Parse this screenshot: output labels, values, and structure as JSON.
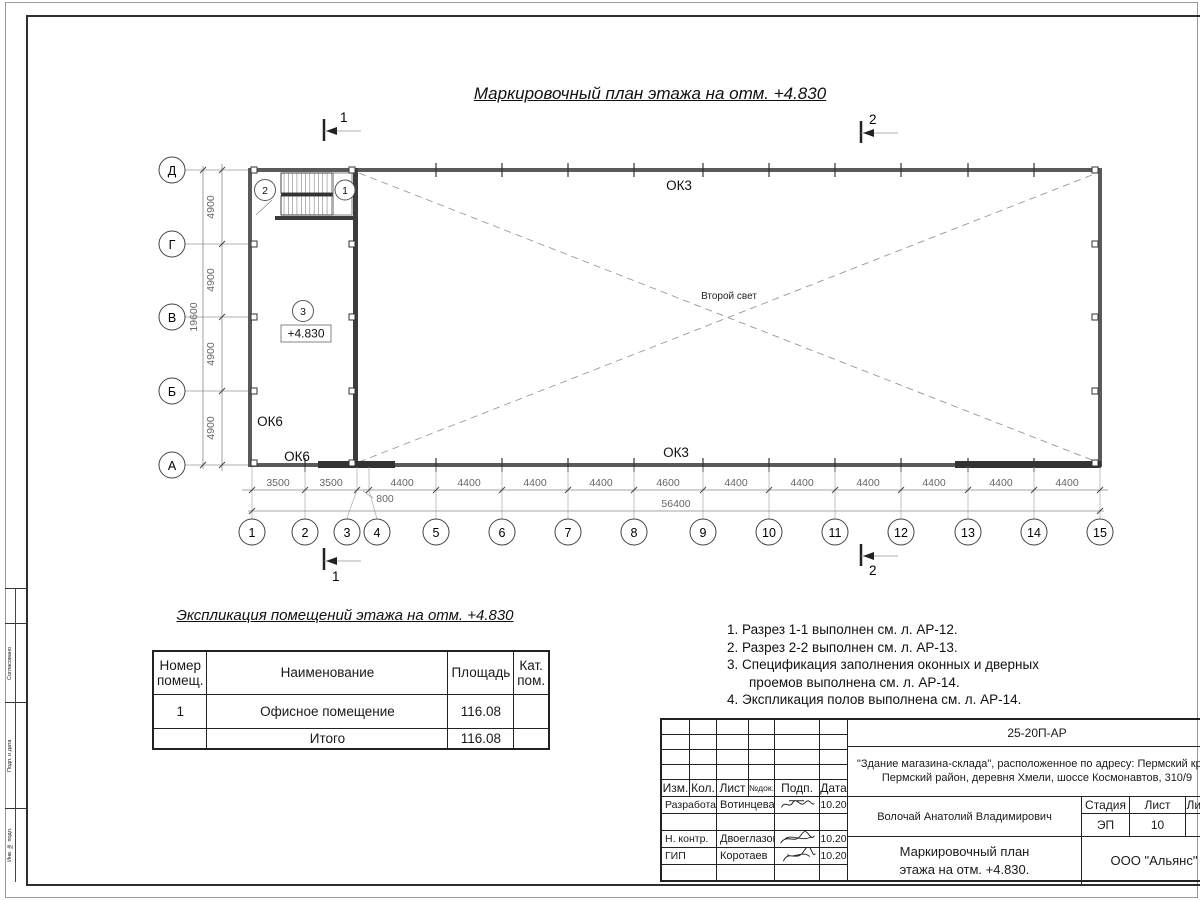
{
  "plan": {
    "title": "Маркировочный план этажа на отм. +4.830",
    "col_axes": [
      "1",
      "2",
      "3",
      "4",
      "5",
      "6",
      "7",
      "8",
      "9",
      "10",
      "11",
      "12",
      "13",
      "14",
      "15"
    ],
    "row_axes": [
      "Д",
      "Г",
      "В",
      "Б",
      "А"
    ],
    "dims_bottom": [
      "3500",
      "3500",
      "4400",
      "4400",
      "4400",
      "4400",
      "4600",
      "4400",
      "4400",
      "4400",
      "4400",
      "4400",
      "4400"
    ],
    "dim_small": "800",
    "dim_total_bottom": "56400",
    "dims_left": [
      "4900",
      "4900",
      "4900",
      "4900"
    ],
    "dim_total_left": "19600",
    "labels": {
      "ok3_top": "ОК3",
      "ok3_bottom": "ОК3",
      "ok6_wall": "ОК6",
      "ok6_bottom": "ОК6",
      "second_light": "Второй свет",
      "level": "+4.830",
      "room": "3",
      "stair_node_left": "2",
      "stair_node_right": "1"
    },
    "sections": {
      "one": "1",
      "two": "2"
    }
  },
  "explication": {
    "title": "Экспликация помещений этажа на отм. +4.830",
    "headers": {
      "number": "Номер помещ.",
      "name": "Наименование",
      "area": "Площадь",
      "cat": "Кат. пом."
    },
    "rows": [
      {
        "number": "1",
        "name": "Офисное помещение",
        "area": "116.08",
        "cat": ""
      }
    ],
    "total_label": "Итого",
    "total_area": "116.08"
  },
  "notes": {
    "line1": "1. Разрез 1-1 выполнен см. л. АР-12.",
    "line2": "2. Разрез 2-2 выполнен см. л. АР-13.",
    "line3": "3. Спецификация заполнения оконных и дверных",
    "line3b": "проемов выполнена см. л. АР-14.",
    "line4": "4. Экспликация полов выполнена см. л. АР-14."
  },
  "stamp": {
    "doc_code": "25-20П-АР",
    "project_line1": "\"Здание магазина-склада\", расположенное по адресу: Пермский край,",
    "project_line2": "Пермский район, деревня Хмели, шоссе Космонавтов, 310/9",
    "header": [
      "Изм.",
      "Кол.",
      "Лист",
      "№док.",
      "Подп.",
      "Дата"
    ],
    "row_developed_label": "Разработал",
    "row_developed_name": "Вотинцева",
    "row_developed_date": "10.20",
    "row_ncontr_label": "Н. контр.",
    "row_ncontr_name": "Двоеглазов",
    "row_ncontr_date": "10.20",
    "row_gip_label": "ГИП",
    "row_gip_name": "Коротаев",
    "row_gip_date": "10.20",
    "chief_name": "Волочай Анатолий Владимирович",
    "stage_label": "Стадия",
    "sheet_label": "Лист",
    "sheets_label": "Листов",
    "stage": "ЭП",
    "sheet_num": "10",
    "title_line1": "Маркировочный план",
    "title_line2": "этажа на отм. +4.830.",
    "company": "ООО \"Альянс\""
  },
  "margin": {
    "cell1": "Согласовано",
    "cell2": "Подп. и дата",
    "cell3": "Инв. № подл."
  }
}
